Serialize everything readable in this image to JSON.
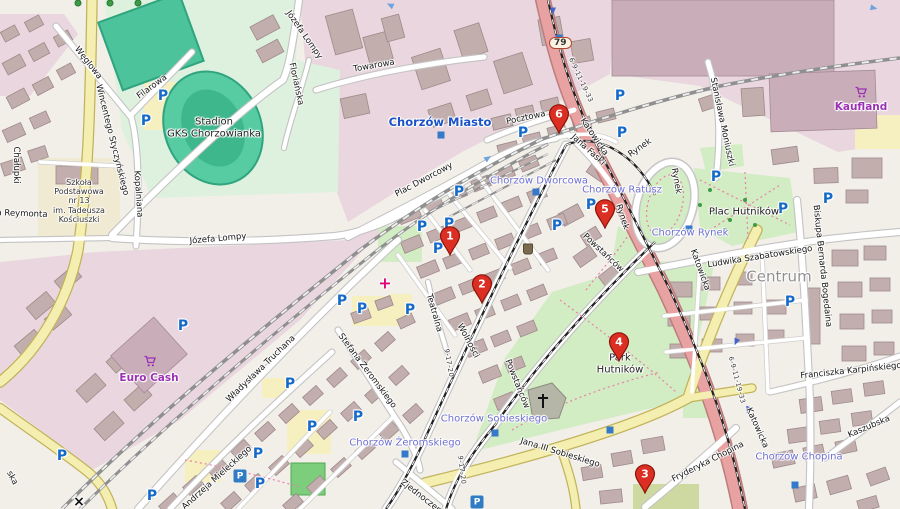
{
  "map": {
    "road_badge": {
      "label": "79"
    },
    "colors": {
      "marker_red": "#dc2f23",
      "station_blue": "#1c52c8",
      "tram_stop_blue": "#6f6fd0",
      "shop_purple": "#9b30b4",
      "parking_blue": "#1569c7",
      "primary_road_pink": "#e8a2a2",
      "park_green": "#d2ecc3",
      "stadium_teal": "#57cba2"
    },
    "markers": [
      {
        "label": "1",
        "x": 450,
        "y": 236
      },
      {
        "label": "2",
        "x": 482,
        "y": 284
      },
      {
        "label": "3",
        "x": 645,
        "y": 474
      },
      {
        "label": "4",
        "x": 619,
        "y": 342
      },
      {
        "label": "5",
        "x": 605,
        "y": 209
      },
      {
        "label": "6",
        "x": 559,
        "y": 114
      }
    ],
    "station_labels_major": [
      {
        "t": "Chorzów Miasto",
        "x": 440,
        "y": 122
      }
    ],
    "station_labels": [
      {
        "t": "Chorzów Dworcowa",
        "x": 539,
        "y": 181
      },
      {
        "t": "Chorzów Ratusz",
        "x": 622,
        "y": 190
      },
      {
        "t": "Chorzów Rynek",
        "x": 690,
        "y": 233
      },
      {
        "t": "Chorzów Żeromskiego",
        "x": 405,
        "y": 443
      },
      {
        "t": "Chorzów Sobieskiego",
        "x": 494,
        "y": 419
      },
      {
        "t": "Chorzów Chopina",
        "x": 799,
        "y": 457
      }
    ],
    "place_labels": [
      {
        "t": "Plac Hutników",
        "x": 744,
        "y": 212,
        "s": 10,
        "c": "#1a1a1a"
      },
      {
        "t": "Centrum",
        "x": 779,
        "y": 277,
        "s": 15,
        "c": "#909090"
      },
      {
        "t": "Stadion\nGKS Chorzowianka",
        "x": 214,
        "y": 128,
        "s": 10,
        "c": "#222222"
      },
      {
        "t": "Park\nHutników",
        "x": 620,
        "y": 364,
        "s": 10,
        "c": "#222222"
      },
      {
        "t": "Szkoła\nPodstawowa\nnr 13\nim. Tadeusza\nKościuszki",
        "x": 79,
        "y": 201,
        "s": 8,
        "c": "#333333"
      }
    ],
    "shop_labels": [
      {
        "t": "Euro Cash",
        "x": 149,
        "y": 378
      },
      {
        "t": "Kaufland",
        "x": 861,
        "y": 107
      }
    ],
    "street_labels": [
      {
        "t": "Węglowa",
        "x": 88,
        "y": 63,
        "r": 52
      },
      {
        "t": "Filarowa",
        "x": 152,
        "y": 87,
        "r": -36
      },
      {
        "t": "Wincentego Styczyńskiego",
        "x": 112,
        "y": 140,
        "r": 76
      },
      {
        "t": "Chałupki",
        "x": 16,
        "y": 165,
        "r": 90
      },
      {
        "t": "a Reymonta",
        "x": 22,
        "y": 214,
        "r": 2
      },
      {
        "t": "Kopalniana",
        "x": 138,
        "y": 194,
        "r": 86
      },
      {
        "t": "Józefa Lompy",
        "x": 304,
        "y": 35,
        "r": 55
      },
      {
        "t": "Józefa Lompy",
        "x": 218,
        "y": 239,
        "r": -5
      },
      {
        "t": "Floriańska",
        "x": 296,
        "y": 84,
        "r": 78
      },
      {
        "t": "Towarowa",
        "x": 374,
        "y": 66,
        "r": -10
      },
      {
        "t": "Plac Dworcowy",
        "x": 424,
        "y": 180,
        "r": -28
      },
      {
        "t": "Pocztowa",
        "x": 526,
        "y": 118,
        "r": -12
      },
      {
        "t": "Stanisława Moniuszki",
        "x": 722,
        "y": 122,
        "r": 78
      },
      {
        "t": "Rynek",
        "x": 640,
        "y": 148,
        "r": -35
      },
      {
        "t": "Rynek",
        "x": 676,
        "y": 181,
        "r": 80
      },
      {
        "t": "Rynek",
        "x": 622,
        "y": 217,
        "r": 72
      },
      {
        "t": "Jana Faski",
        "x": 588,
        "y": 150,
        "r": 42
      },
      {
        "t": "Katowicka",
        "x": 594,
        "y": 137,
        "r": 56
      },
      {
        "t": "Katowicka",
        "x": 700,
        "y": 270,
        "r": 70
      },
      {
        "t": "Katowicka",
        "x": 757,
        "y": 428,
        "r": 66
      },
      {
        "t": "Powstańców",
        "x": 603,
        "y": 253,
        "r": 43
      },
      {
        "t": "Powstańców",
        "x": 517,
        "y": 384,
        "r": 68
      },
      {
        "t": "Wolności",
        "x": 468,
        "y": 341,
        "r": 62
      },
      {
        "t": "Teatralna",
        "x": 434,
        "y": 313,
        "r": 74
      },
      {
        "t": "Stefana Żeromskiego",
        "x": 367,
        "y": 371,
        "r": 53
      },
      {
        "t": "Władysława Truchana",
        "x": 261,
        "y": 369,
        "r": -44
      },
      {
        "t": "Andrzeja Mieleckiego",
        "x": 217,
        "y": 478,
        "r": -42
      },
      {
        "t": "Zjednoczenia",
        "x": 424,
        "y": 499,
        "r": 38
      },
      {
        "t": "Jana III Sobieskiego",
        "x": 560,
        "y": 453,
        "r": 17
      },
      {
        "t": "Fryderyka Chopina",
        "x": 708,
        "y": 462,
        "r": -27
      },
      {
        "t": "Franciszka Karpińskiego",
        "x": 851,
        "y": 371,
        "r": -6
      },
      {
        "t": "Kaszubska",
        "x": 869,
        "y": 427,
        "r": -23
      },
      {
        "t": "Ludwika Szabatowskiego",
        "x": 760,
        "y": 257,
        "r": -9
      },
      {
        "t": "Biskupa Bernarda Bogedaina",
        "x": 822,
        "y": 266,
        "r": 84
      },
      {
        "t": "ska",
        "x": 12,
        "y": 478,
        "r": 62
      }
    ],
    "transit_refs": [
      {
        "t": "9-17-20",
        "x": 449,
        "y": 363,
        "r": 80
      },
      {
        "t": "9-17-20",
        "x": 462,
        "y": 470,
        "r": 83
      },
      {
        "t": "6-9-11-19-33",
        "x": 581,
        "y": 80,
        "r": 65
      },
      {
        "t": "6-9-11-19-33",
        "x": 737,
        "y": 380,
        "r": 75
      }
    ],
    "parking_icons": [
      [
        163,
        96
      ],
      [
        146,
        121
      ],
      [
        523,
        133
      ],
      [
        620,
        96
      ],
      [
        622,
        133
      ],
      [
        459,
        192
      ],
      [
        716,
        177
      ],
      [
        783,
        209
      ],
      [
        828,
        199
      ],
      [
        422,
        227
      ],
      [
        449,
        224
      ],
      [
        557,
        226
      ],
      [
        591,
        205
      ],
      [
        438,
        249
      ],
      [
        410,
        310
      ],
      [
        342,
        301
      ],
      [
        362,
        309
      ],
      [
        183,
        326
      ],
      [
        290,
        384
      ],
      [
        358,
        417
      ],
      [
        312,
        427
      ],
      [
        258,
        454
      ],
      [
        260,
        484
      ],
      [
        152,
        496
      ],
      [
        790,
        302
      ],
      [
        62,
        456
      ]
    ],
    "parking_box_icons": [
      [
        477,
        502
      ],
      [
        240,
        476
      ]
    ],
    "stop_icons": [
      [
        441,
        135
      ],
      [
        536,
        192
      ],
      [
        405,
        454
      ],
      [
        495,
        433
      ],
      [
        610,
        430
      ],
      [
        689,
        229
      ],
      [
        795,
        485
      ],
      [
        559,
        38
      ]
    ],
    "oneway_arrows": [
      {
        "x": 390,
        "y": 5,
        "r": 205,
        "c": "#6fa3e0"
      },
      {
        "x": 553,
        "y": 11,
        "r": 90,
        "c": "#4664c8"
      },
      {
        "x": 488,
        "y": 158,
        "r": -35,
        "c": "#6fa3e0"
      },
      {
        "x": 874,
        "y": 8,
        "r": 12,
        "c": "#6fa3e0"
      },
      {
        "x": 736,
        "y": 342,
        "r": 112,
        "c": "#4664c8"
      },
      {
        "x": 748,
        "y": 410,
        "r": 108,
        "c": "#4664c8"
      }
    ],
    "crossing_icons": [
      {
        "x": 79,
        "y": 502,
        "glyph": "×"
      }
    ],
    "hospital_icon": {
      "x": 385,
      "y": 283,
      "glyph": "+"
    },
    "waste_icon": {
      "x": 528,
      "y": 249
    },
    "cart_icons": [
      [
        150,
        362
      ],
      [
        861,
        93
      ]
    ],
    "tree_icons": [
      [
        78,
        3
      ],
      [
        110,
        3
      ],
      [
        138,
        3
      ]
    ]
  }
}
